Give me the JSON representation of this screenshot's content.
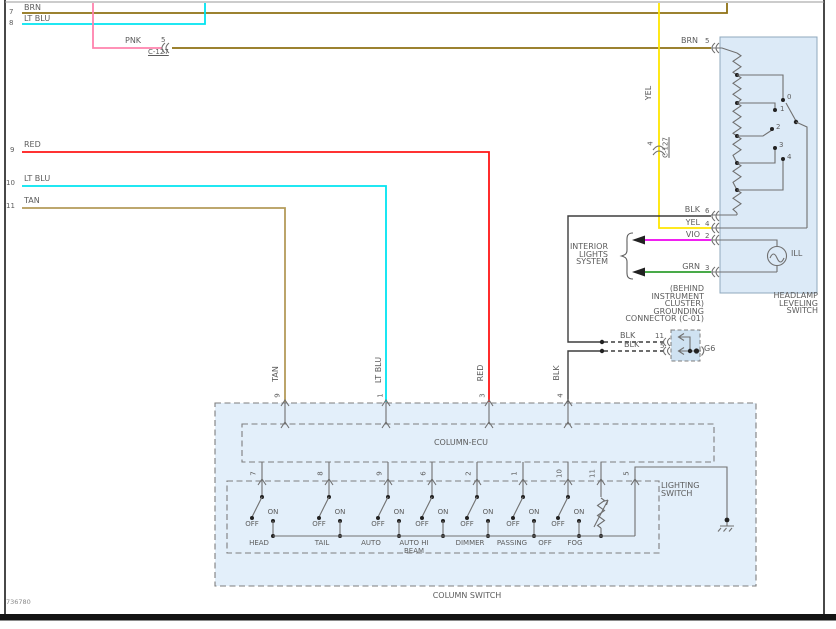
{
  "doc_number": "736780",
  "colors": {
    "brn": "#8e7113",
    "lt_blu": "#00e4f0",
    "pnk": "#ff82ad",
    "red": "#ff1515",
    "tan": "#b49b5a",
    "yel": "#ffe600",
    "vio": "#ee00ee",
    "grn": "#2f9e2f",
    "blk": "#3d3d3d",
    "circuit": "#707070",
    "box_fill": "#dceaf7",
    "conn_fill": "#cfe2f2"
  },
  "top_left_wires": [
    {
      "row": "7",
      "label": "BRN"
    },
    {
      "row": "8",
      "label": "LT BLU"
    }
  ],
  "pnk_branch": {
    "label": "PNK",
    "pin": "5",
    "connector": "C-127"
  },
  "brn_feed": {
    "label": "BRN",
    "pin": "5"
  },
  "left_wires": [
    {
      "row": "9",
      "label": "RED"
    },
    {
      "row": "10",
      "label": "LT BLU"
    },
    {
      "row": "11",
      "label": "TAN"
    }
  ],
  "yel_feed": {
    "label": "YEL",
    "pin": "4",
    "connector": "C-127"
  },
  "vertical_wire_labels": [
    "TAN",
    "LT BLU",
    "RED",
    "BLK"
  ],
  "headlamp_switch": {
    "title_lines": [
      "HEADLAMP",
      "LEVELING",
      "SWITCH"
    ],
    "pins": [
      {
        "wire": "BLK",
        "num": "6"
      },
      {
        "wire": "YEL",
        "num": "4"
      },
      {
        "wire": "VIO",
        "num": "2"
      },
      {
        "wire": "GRN",
        "num": "3"
      }
    ],
    "positions": [
      "0",
      "1",
      "2",
      "3",
      "4"
    ],
    "lamp": "ILL"
  },
  "interior_lights": {
    "lines": [
      "INTERIOR",
      "LIGHTS",
      "SYSTEM"
    ]
  },
  "grounding_connector": {
    "note_lines": [
      "(BEHIND",
      "INSTRUMENT",
      "CLUSTER)",
      "GROUNDING",
      "CONNECTOR (C-01)"
    ],
    "pins": [
      {
        "wire": "BLK",
        "num": "11"
      },
      {
        "wire": "BLK",
        "num": "5"
      }
    ],
    "ground": "G6"
  },
  "column_switch": {
    "title": "COLUMN SWITCH",
    "ecu": "COLUMN-ECU",
    "lighting_lines": [
      "LIGHTING",
      "SWITCH"
    ],
    "top_pins": [
      "9",
      "1",
      "3",
      "4"
    ],
    "switches": [
      {
        "pin": "7",
        "name": "HEAD",
        "on": "ON",
        "off": "OFF"
      },
      {
        "pin": "8",
        "name": "TAIL",
        "on": "ON",
        "off": "OFF"
      },
      {
        "pin": "9",
        "name": "AUTO",
        "on": "ON",
        "off": "OFF"
      },
      {
        "pin": "6",
        "name": "AUTO HI",
        "name2": "BEAM",
        "on": "ON",
        "off": "OFF"
      },
      {
        "pin": "2",
        "name": "DIMMER",
        "on": "ON",
        "off": "OFF"
      },
      {
        "pin": "1",
        "name": "PASSING",
        "on": "ON",
        "off": "OFF"
      },
      {
        "pin": "10",
        "name": "OFF",
        "on": "ON",
        "off": "OFF"
      },
      {
        "pin": "11",
        "name": "FOG"
      },
      {
        "pin": "5"
      }
    ]
  }
}
